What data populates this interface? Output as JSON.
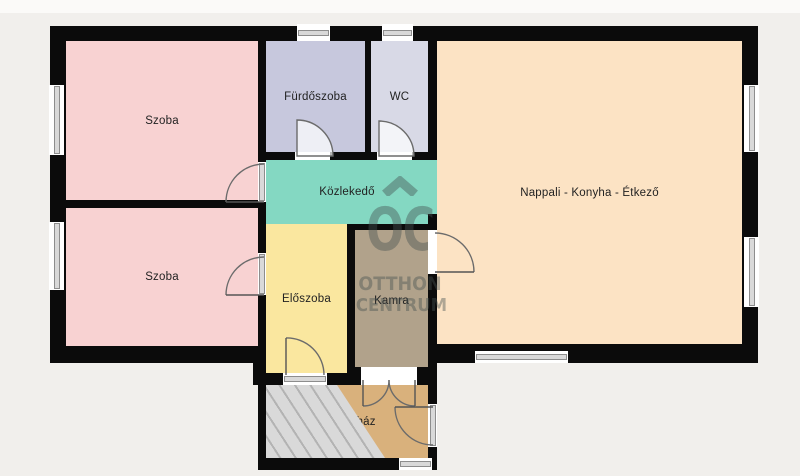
{
  "plan": {
    "type": "apartment-floorplan",
    "background": "#f1efec",
    "top_strip": "#fbfaf8"
  },
  "rooms": [
    {
      "id": "szoba1",
      "label": "Szoba",
      "color": "#f8d2d2"
    },
    {
      "id": "szoba2",
      "label": "Szoba",
      "color": "#f8d2d2"
    },
    {
      "id": "furdo",
      "label": "Fürdőszoba",
      "color": "#c7c8dd"
    },
    {
      "id": "wc",
      "label": "WC",
      "color": "#d8d9e6"
    },
    {
      "id": "koz",
      "label": "Közlekedő",
      "color": "#84d8c2"
    },
    {
      "id": "elo",
      "label": "Előszoba",
      "color": "#fae79f"
    },
    {
      "id": "kamra",
      "label": "Kamra",
      "color": "#b1a28b"
    },
    {
      "id": "nappali",
      "label": "Nappali - Konyha - Étkező",
      "color": "#fce3c4"
    },
    {
      "id": "lepcso",
      "label": "Lépcsőház",
      "color": "#d9b17c"
    }
  ],
  "watermark": {
    "brand_monogram": "OC",
    "line1": "OTTHON",
    "line2": "CENTRUM",
    "color": "rgba(70,82,80,0.42)"
  },
  "palette": {
    "wall": "#0b0b0b",
    "window_frame": "#8d8d8d",
    "window_glass": "#d9d9d9",
    "door_stroke": "#6b6b6b",
    "stairs_bg": "#d9d9d9",
    "stairs_stripe": "#b3b3b3"
  }
}
